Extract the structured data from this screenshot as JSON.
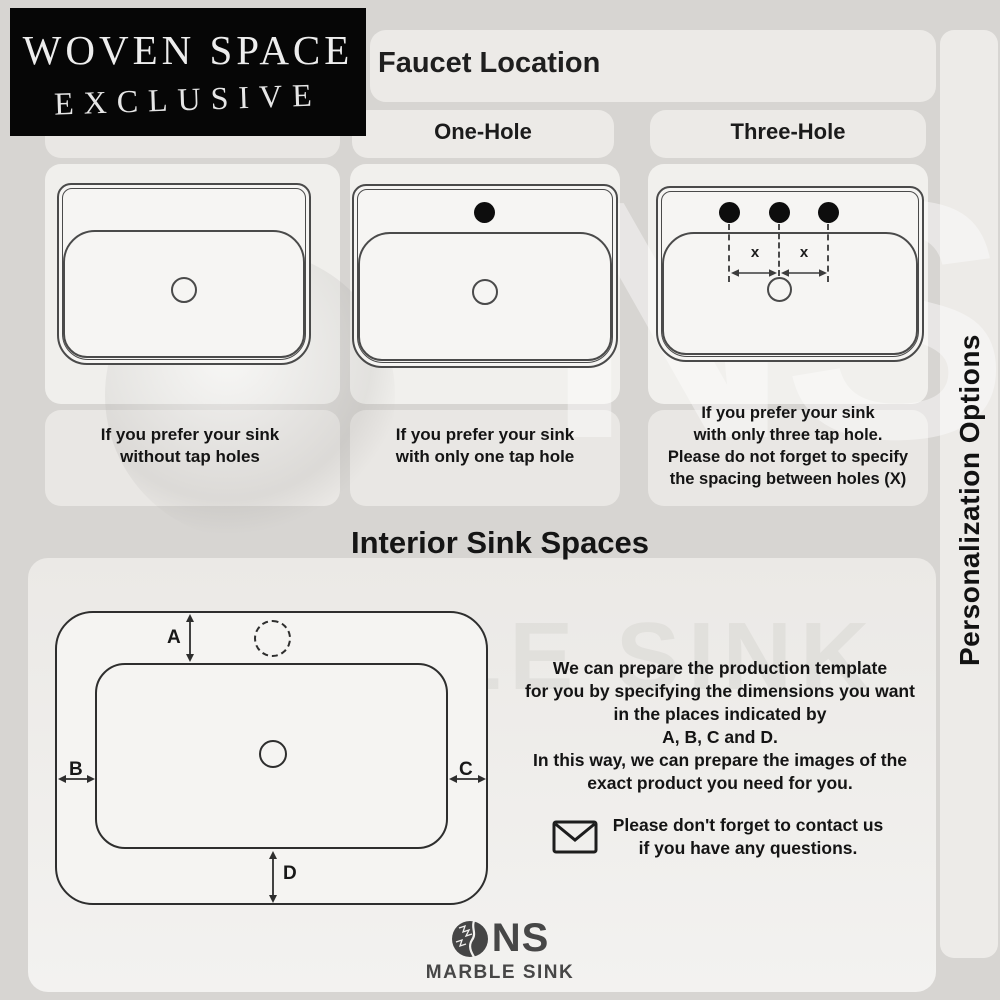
{
  "brand": {
    "line1": "WOVEN SPACE",
    "line2": "EXCLUSIVE"
  },
  "faucet_section": {
    "title": "Faucet Location",
    "options": {
      "one": "One-Hole",
      "three": "Three-Hole"
    },
    "spacing_label": "x",
    "captions": {
      "no_hole": "If you prefer your sink\nwithout tap holes",
      "one_hole": "If you prefer your sink\nwith only one tap hole",
      "three_hole": "If you prefer your sink\nwith only three tap hole.\nPlease do not forget to specify\nthe spacing between holes (X)"
    }
  },
  "interior_section": {
    "title": "Interior Sink Spaces",
    "dims": {
      "a": "A",
      "b": "B",
      "c": "C",
      "d": "D"
    },
    "description": "We can prepare the production template\nfor you by specifying the dimensions you want\nin the places indicated by\nA, B, C and D.\nIn this way, we can prepare the images of the\nexact product you need for you.",
    "contact_note": "Please don't forget to contact us\nif you have any questions."
  },
  "side_banner": {
    "label": "Personalization Options"
  },
  "footer_logo": {
    "initials": "NS",
    "name": "MARBLE SINK"
  },
  "watermark": {
    "text": "MARBLE SINK",
    "initials": "NS"
  },
  "icons": {
    "envelope": "envelope-icon",
    "marble_ball": "marble-ball-icon"
  },
  "colors": {
    "line": "#4a4a4a",
    "tap_hole": "#0d0d0d",
    "brand_bg": "#060606",
    "brand_text": "#ededed",
    "footer_text": "#474747"
  }
}
